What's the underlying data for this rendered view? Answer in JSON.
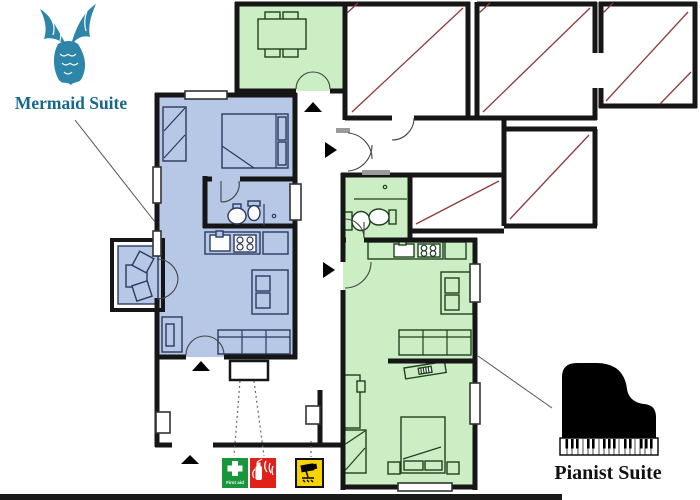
{
  "labels": {
    "mermaid_suite": "Mermaid Suite",
    "pianist_suite": "Pianist Suite"
  },
  "signs": {
    "first_aid_label": "First aid"
  },
  "icons": {
    "mermaid_logo": "mermaid-tail-icon",
    "pianist_logo": "grand-piano-icon",
    "first_aid": "first-aid-cross-icon",
    "fire": "fire-extinguisher-icon",
    "cctv": "cctv-camera-icon"
  },
  "colors": {
    "mermaid_suite_fill": "#b7c7e6",
    "pianist_suite_fill": "#cbeec4",
    "hatch_line": "#8e3b3b",
    "wall": "#161616",
    "mermaid_logo": "#2d86a9",
    "mermaid_text": "#15688a",
    "pianist_text": "#111111",
    "first_aid_green": "#18963b",
    "fire_red": "#e02019",
    "cctv_yellow": "#f7d300"
  }
}
